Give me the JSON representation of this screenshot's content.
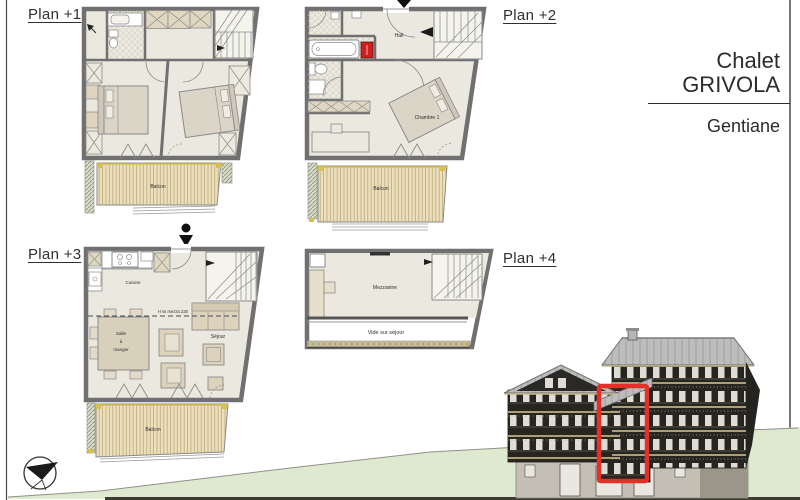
{
  "title_block": {
    "building_line1": "Chalet",
    "building_line2": "GRIVOLA",
    "unit_name": "Gentiane"
  },
  "plan1": {
    "label": "Plan +1",
    "balcony": "Balcon"
  },
  "plan2": {
    "label": "Plan +2",
    "hall": "Hall",
    "bedroom1": "Chambre 1",
    "balcony": "Balcon"
  },
  "plan3": {
    "label": "Plan +3",
    "kitchen": "Cuisine",
    "dining_line1": "Salle",
    "dining_line2": "à",
    "dining_line3": "manger",
    "living": "Séjour",
    "mezzanine_height_note": "H ss mezza 220",
    "balcony": "Balcon"
  },
  "plan4": {
    "label": "Plan +4",
    "mezzanine": "Mezzanine",
    "void_label": "Vide sur séjour"
  },
  "elevation": {
    "highlight_color": "#e33028"
  },
  "colors": {
    "hill_green": "#dfe9cf",
    "balcony_deck": "#ecdfbb",
    "room_fill": "#ebe9df",
    "wall_gray": "#707070",
    "duct_red": "#cc2020",
    "roof_gray": "#bdbdbd",
    "facade_dark": "#26251f",
    "accent_yellow": "#d6c14c"
  },
  "icons": {
    "north_compass": "north-compass-icon",
    "entrance_marker": "entrance-arrow-icon"
  }
}
